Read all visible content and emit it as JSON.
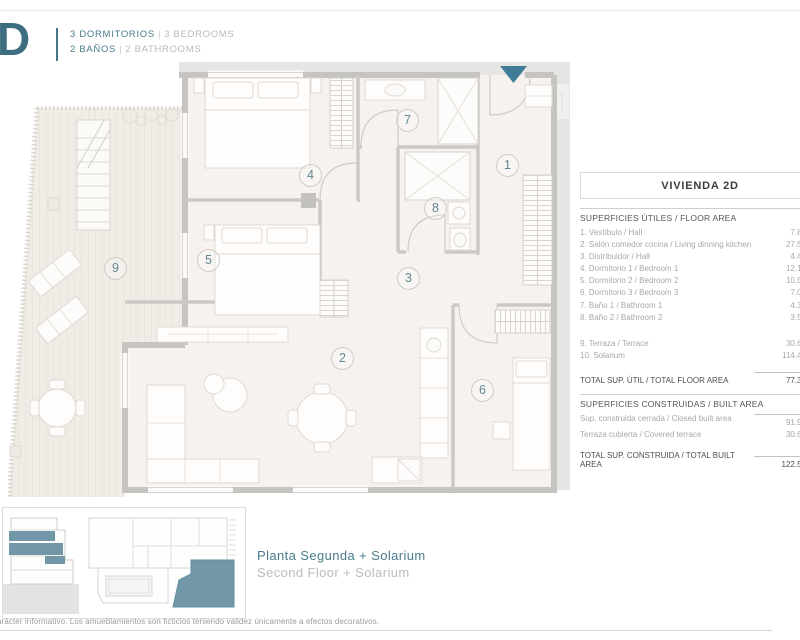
{
  "header": {
    "unit": "D",
    "bedrooms_es": "3 DORMITORIOS",
    "bedrooms_en": "3 BEDROOMS",
    "baths_es": "2 BAÑOS",
    "baths_en": "2 BATHROOMS",
    "sep": "|"
  },
  "plan": {
    "room_numbers": [
      "1",
      "2",
      "3",
      "4",
      "5",
      "6",
      "7",
      "8",
      "9"
    ]
  },
  "panel": {
    "title": "VIVIENDA 2D",
    "floor_area": {
      "heading": "SUPERFICIES ÚTILES / FLOOR AREA",
      "rows": [
        {
          "label": "1. Vestíbulo / Hall",
          "value": "7.83"
        },
        {
          "label": "2. Salón comedor cocina / Living dinning kitchen",
          "value": "27.50"
        },
        {
          "label": "3. Distribuidor / Hall",
          "value": "4.43"
        },
        {
          "label": "4. Dormitorio 1 / Bedroom 1",
          "value": "12.13"
        },
        {
          "label": "5. Dormitorio 2 / Bedroom 2",
          "value": "10.53"
        },
        {
          "label": "6. Dormitorio 3 / Bedroom 3",
          "value": "7.07"
        },
        {
          "label": "7. Baño 1 / Bathroom 1",
          "value": "4.32"
        },
        {
          "label": "8. Baño 2 / Bathroom 2",
          "value": "3.56"
        }
      ],
      "outdoor_rows": [
        {
          "label": "9. Terraza / Terrace",
          "value": "30.64"
        },
        {
          "label": "10. Solarium",
          "value": "114.42"
        }
      ],
      "total": {
        "label": "TOTAL SUP. ÚTIL / TOTAL FLOOR AREA",
        "value": "77.37"
      }
    },
    "built_area": {
      "heading": "SUPERFICIES CONSTRUIDAS / BUILT AREA",
      "rows": [
        {
          "label": "Sup. construida cerrada / Closed built area",
          "value": "91.91"
        },
        {
          "label": "Terraza cubierta / Covered terrace",
          "value": "30.64"
        }
      ],
      "total": {
        "label": "TOTAL SUP. CONSTRUIDA /  TOTAL BUILT AREA",
        "value": "122.54"
      }
    }
  },
  "keyplan": {
    "caption_es": "Planta Segunda + Solarium",
    "caption_en": "Second Floor + Solarium"
  },
  "footer": {
    "disclaimer": "arácter informativo. Los amueblamientos son ficticios teniendo validez únicamente a efectos decorativos."
  },
  "colors": {
    "accent_teal": "#3e7c97",
    "teal_text": "#4a7b8c",
    "muted_gray": "#b7babc",
    "wall_gray": "#c6c4c1",
    "floor": "#f7f2ee"
  }
}
